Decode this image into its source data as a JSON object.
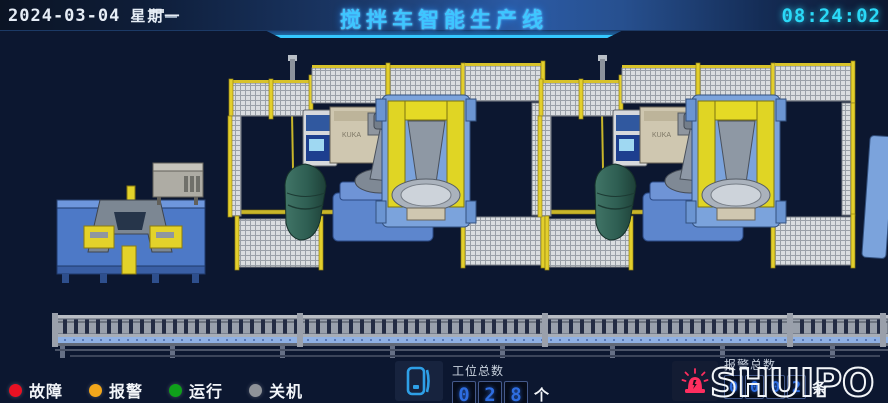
{
  "header": {
    "date": "2024-03-04",
    "weekday": "星期一",
    "title": "搅拌车智能生产线",
    "time": "08:24:02"
  },
  "theme": {
    "background": "#0c1730",
    "accent_cyan": "#35c8ff",
    "time_color": "#2ad9f7",
    "digit_blue": "#2e6de0",
    "fence_yellow": "#e3cf2c",
    "robot_blue": "#5d86cd",
    "positioner_yellow": "#e0d524",
    "drum_green": "#2e5e52"
  },
  "legend": {
    "items": [
      {
        "id": "fault",
        "label": "故障",
        "color": "#e81123"
      },
      {
        "id": "alarm",
        "label": "报警",
        "color": "#f2a71b"
      },
      {
        "id": "running",
        "label": "运行",
        "color": "#0fa01a"
      },
      {
        "id": "shutdown",
        "label": "关机",
        "color": "#8f9399"
      }
    ]
  },
  "counters": {
    "stations": {
      "label": "工位总数",
      "digits": [
        "0",
        "2",
        "8"
      ],
      "unit": "个"
    },
    "alarms": {
      "label": "报警总数",
      "digits": [
        "0",
        "0",
        "0",
        "2"
      ],
      "unit": "条"
    }
  },
  "icons": {
    "device": "phone-icon",
    "alarm": "alarm-beacon-icon"
  },
  "logo": {
    "text": "SHUIPO"
  },
  "scene": {
    "robot_brand": "KUKA",
    "cells": [
      {
        "name": "welding-cell-1"
      },
      {
        "name": "welding-cell-2"
      }
    ]
  }
}
